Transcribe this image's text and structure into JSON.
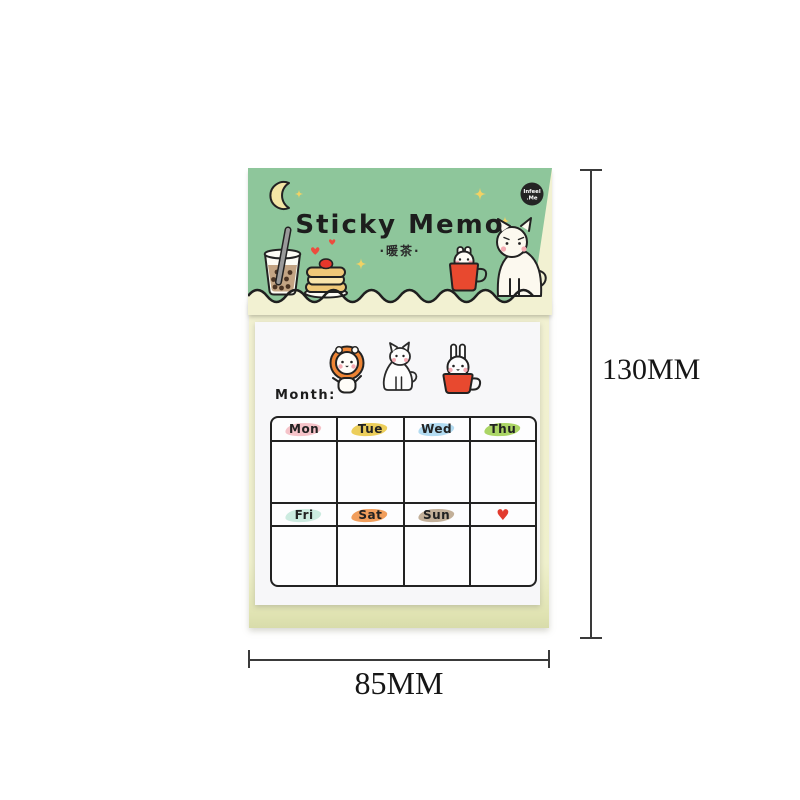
{
  "header": {
    "title": "Sticky Memo",
    "subtitle": "·暖茶·",
    "badge": {
      "line1": "Infeel",
      "line2": ".Me"
    },
    "bg_color": "#8ec69b",
    "illustrations": [
      "crescent-moon",
      "sparkles",
      "bubble-tea",
      "hearts",
      "pancakes-with-strawberry",
      "rabbit-in-mug",
      "sitting-cat"
    ]
  },
  "sheet": {
    "month_label": "Month:",
    "paper_color": "#f7f7f9",
    "illustrations": [
      "lion-cub",
      "cat-outline",
      "rabbit-in-mug"
    ]
  },
  "calendar": {
    "days": [
      {
        "label": "Mon",
        "highlight": "#f3b8bf",
        "color": "#222222"
      },
      {
        "label": "Tue",
        "highlight": "#e9c53e",
        "color": "#222222"
      },
      {
        "label": "Wed",
        "highlight": "#a5d5ef",
        "color": "#222222"
      },
      {
        "label": "Thu",
        "highlight": "#9cce4a",
        "color": "#222222"
      },
      {
        "label": "Fri",
        "highlight": "#c3e7db",
        "color": "#222222"
      },
      {
        "label": "Sat",
        "highlight": "#ef8d3f",
        "color": "#222222"
      },
      {
        "label": "Sun",
        "highlight": "#b9a287",
        "color": "#222222"
      },
      {
        "label": "♥",
        "highlight": "",
        "color": "#e23b2e"
      }
    ]
  },
  "dimensions": {
    "height": "130MM",
    "width": "85MM"
  },
  "colors": {
    "pad_cream": "#f2f1d2",
    "mug_red": "#e8492f",
    "mane_orange": "#ee8434",
    "heart_red": "#ed4c3e"
  }
}
